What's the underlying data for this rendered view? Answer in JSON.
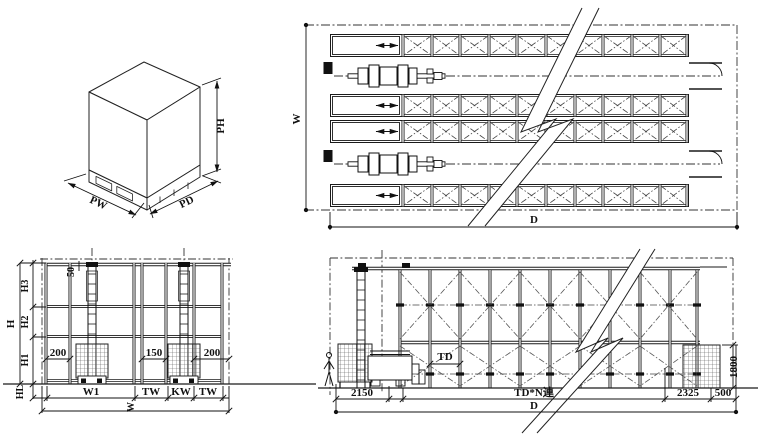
{
  "views": {
    "unit_load": {
      "labels": {
        "pw": "PW",
        "pd": "PD",
        "ph": "PH"
      }
    },
    "plan": {
      "labels": {
        "width": "W",
        "depth": "D"
      }
    },
    "front_elevation": {
      "labels": {
        "clearance_top": "50",
        "h_total": "H",
        "h3": "H3",
        "h2": "H2",
        "h1": "H1",
        "hl": "HL",
        "gap_left": "200",
        "gap_mid": "150",
        "gap_right": "200",
        "w1": "W1",
        "tw_left": "TW",
        "kw": "KW",
        "tw_right": "TW",
        "w_total": "W"
      }
    },
    "side_elevation": {
      "labels": {
        "td": "TD",
        "front_zone": "2150",
        "rack_zone": "TD*N連",
        "rear_zone": "2325",
        "end_zone": "500",
        "station_height": "1800",
        "d_total": "D"
      }
    }
  },
  "colors": {
    "line": "#1a1a1a",
    "background": "#ffffff",
    "hatch": "#555555"
  }
}
